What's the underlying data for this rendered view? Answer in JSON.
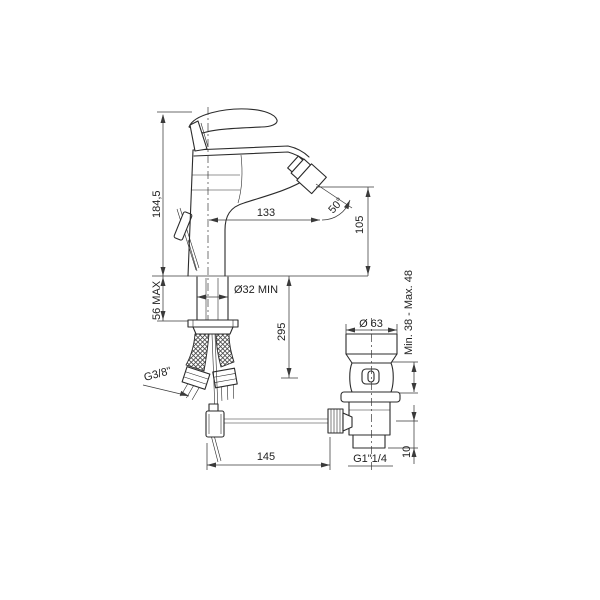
{
  "drawing": {
    "background": "#ffffff",
    "line_color": "#2b2b2b",
    "text_color": "#222222",
    "labels": {
      "overall_height": "184,5",
      "base_max_thickness": "56 MAX",
      "hole_min_diameter": "Ø32 MIN",
      "hose_length": "295",
      "spout_reach": "133",
      "spout_angle": "50°",
      "outlet_height": "105",
      "waste_cap_diameter": "Ø 63",
      "waste_adjustment": "Min. 38 - Max. 48",
      "supply_thread": "G3/8\"",
      "rod_length": "145",
      "waste_thread": "G1\"1/4",
      "waste_tail_length": "10"
    }
  }
}
